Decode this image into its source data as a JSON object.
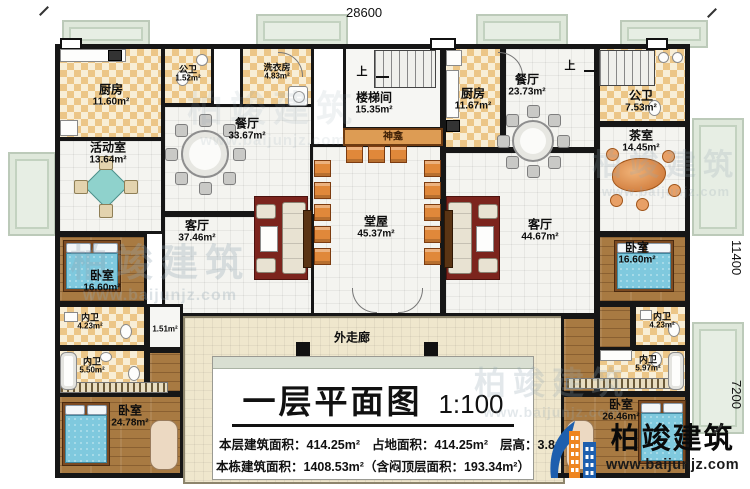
{
  "dims": {
    "top": "28600",
    "right_upper": "11400",
    "right_lower": "7200"
  },
  "up_label": "上",
  "rooms": [
    {
      "name": "厨房",
      "area": "11.60m²"
    },
    {
      "name": "公卫",
      "area": "1.52m²"
    },
    {
      "name": "洗衣房",
      "area": "4.83m²"
    },
    {
      "name": "餐厅",
      "area": "33.67m²"
    },
    {
      "name": "活动室",
      "area": "13.64m²"
    },
    {
      "name": "楼梯间",
      "area": "15.35m²"
    },
    {
      "name": "神龛"
    },
    {
      "name": "厨房",
      "area": "11.67m²"
    },
    {
      "name": "餐厅",
      "area": "23.73m²"
    },
    {
      "name": "公卫",
      "area": "7.53m²"
    },
    {
      "name": "茶室",
      "area": "14.45m²"
    },
    {
      "name": "堂屋",
      "area": "45.37m²"
    },
    {
      "name": "客厅",
      "area": "37.46m²"
    },
    {
      "name": "客厅",
      "area": "44.67m²"
    },
    {
      "name": "卧室",
      "area": "16.60m²"
    },
    {
      "name": "内卫",
      "area": "4.23m²"
    },
    {
      "area": "1.51m²"
    },
    {
      "name": "内卫",
      "area": "5.50m²"
    },
    {
      "name": "卧室",
      "area": "24.78m²"
    },
    {
      "name": "卧室",
      "area": "16.60m²"
    },
    {
      "name": "内卫",
      "area": "4.23m²"
    },
    {
      "name": "内卫",
      "area": "5.97m²"
    },
    {
      "name": "卧室",
      "area": "26.46m²"
    },
    {
      "name": "外走廊"
    }
  ],
  "title_block": {
    "title": "一层平面图",
    "scale": "1:100",
    "stat1a": "本层建筑面积：414.25m²",
    "stat1b": "占地面积：414.25m²",
    "stat1c": "层高：3.8m",
    "stat2": "本栋建筑面积：1408.53m²（含闷顶层面积：193.34m²）"
  },
  "brand": {
    "name": "柏竣建筑",
    "url": "www.baijunjz.com"
  },
  "watermark": {
    "name": "柏竣建筑",
    "url": "www.baijunjz.com"
  },
  "colors": {
    "wall": "#161616",
    "checker_tile": "#ecc687",
    "wood_floor": "#a87a42",
    "porch": "#e7eee4",
    "corridor": "#efe7cd",
    "chair_orange": "#e0883a",
    "bed_blue": "#7fc9de",
    "rug_red": "#7c241d",
    "logo_blue": "#1d5fae",
    "logo_orange": "#ee8520",
    "watermark_gray": "#92a6b2"
  }
}
